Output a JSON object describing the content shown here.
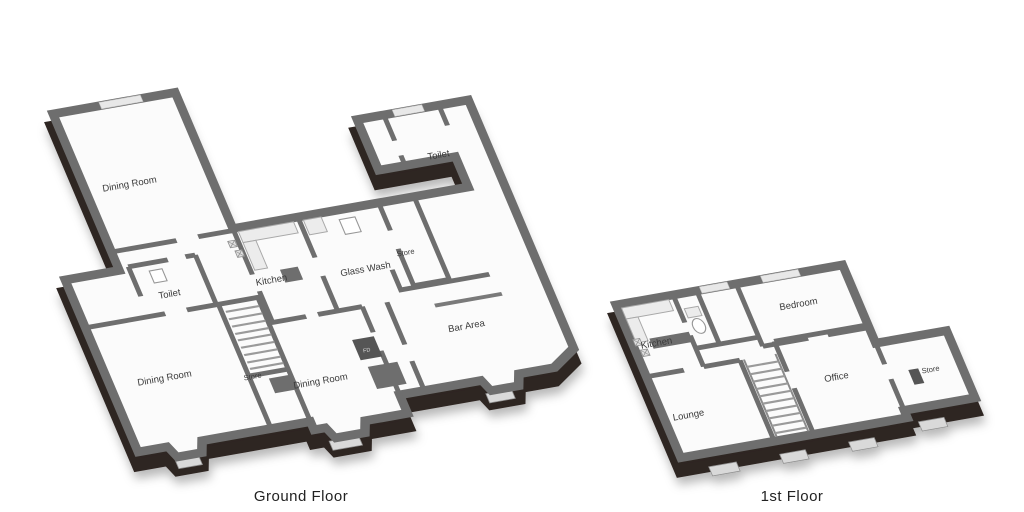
{
  "page": {
    "background": "#ffffff",
    "type_hint": "3D floorplan illustration, two floors"
  },
  "colors": {
    "wall_front": "#2f2521",
    "wall_top": "#6e6e6e",
    "floor": "#fbfbfb",
    "window": "#d9d9d9"
  },
  "icons": {
    "appliance_marker": "snowflake-hatch"
  },
  "ground_floor": {
    "title": "Ground Floor",
    "rooms": {
      "dining_room_top": "Dining Room",
      "toilet_left": "Toilet",
      "kitchen": "Kitchen",
      "glass_wash": "Glass Wash",
      "store_top": "Store",
      "toilet_wing": "Toilet",
      "bar_area": "Bar Area",
      "dining_room_left": "Dining Room",
      "store_mid": "Store",
      "dining_room_mid": "Dining Room",
      "fire_door": "FD"
    }
  },
  "first_floor": {
    "title": "1st Floor",
    "rooms": {
      "kitchen": "Kitchen",
      "bedroom": "Bedroom",
      "office": "Office",
      "store": "Store",
      "lounge": "Lounge"
    }
  }
}
